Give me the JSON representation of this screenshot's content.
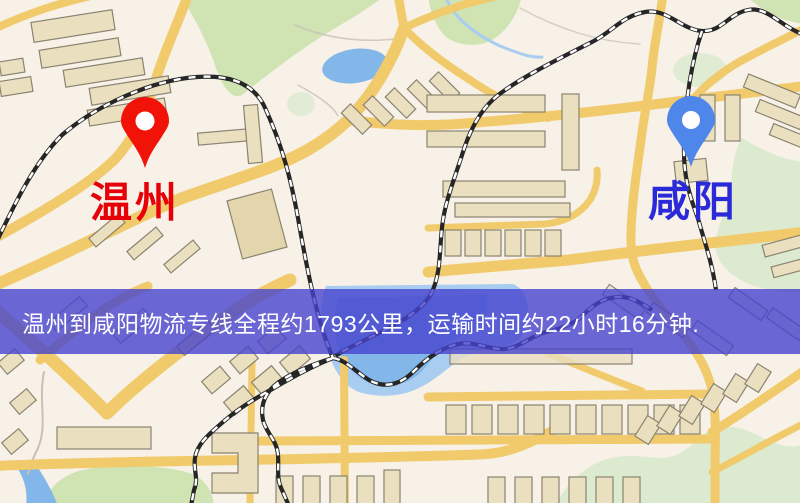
{
  "page": {
    "width_px": 800,
    "height_px": 503,
    "description_name": "logistics-route-map"
  },
  "map": {
    "origin": {
      "label": "温州",
      "label_color": "#e60008",
      "pin_color": "#ee1408"
    },
    "destination": {
      "label": "咸阳",
      "label_color": "#2a2ad8",
      "pin_color": "#4f86e8"
    }
  },
  "banner": {
    "text": "温州到咸阳物流专线全程约1793公里，运输时间约22小时16分钟.",
    "background": "rgba(70,68,206,0.8)",
    "text_color": "#ffffff",
    "origin": "温州",
    "destination": "咸阳",
    "distance_km": "1793",
    "duration": "22小时16分钟"
  },
  "palette": {
    "background": "#f7f1e8",
    "road": "#f0ca6e",
    "building_fill": "#eadfc0",
    "building_stroke": "#8a8370",
    "building_dark": "#e3d6ae",
    "green": "#cfe3b4",
    "green_pale": "#dcead0",
    "water": "#84b6e8",
    "water_light": "#a9cdf0",
    "railway_dark": "#262626",
    "railway_light": "#ffffff",
    "stream": "#c6c1b4"
  }
}
